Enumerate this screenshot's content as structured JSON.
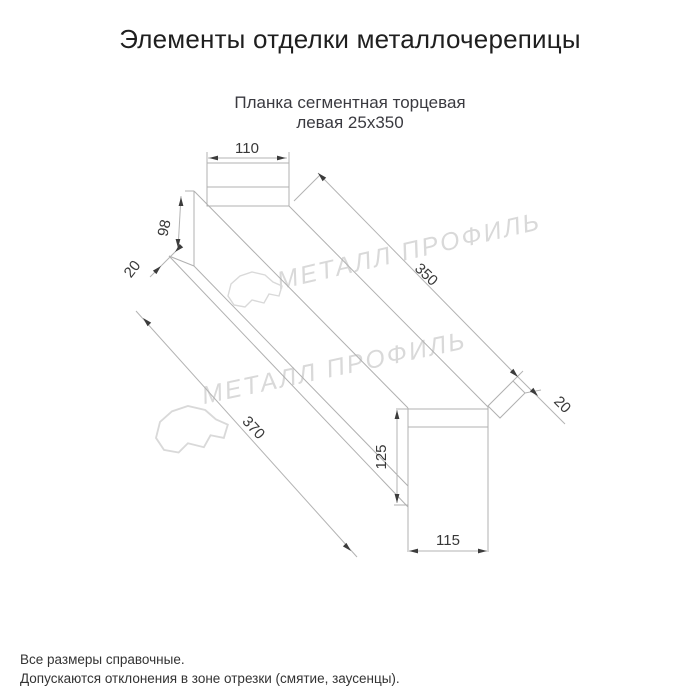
{
  "title": "Элементы отделки металлочерепицы",
  "product": {
    "name_line1": "Планка сегментная торцевая",
    "name_line2": "левая 25х350"
  },
  "drawing": {
    "dims": {
      "top_flange_width": "110",
      "slope_face": "98",
      "hem_near": "20",
      "length_right": "350",
      "hem_far": "20",
      "length_left": "370",
      "end_height": "125",
      "end_width": "115"
    },
    "line_color": "#b0b0b0",
    "dim_text_color": "#383838",
    "watermark": {
      "text": "МЕТАЛЛ ПРОФИЛЬ",
      "color": "#d9d9d9"
    }
  },
  "notes": {
    "line1": "Все размеры справочные.",
    "line2": "Допускаются отклонения в зоне отрезки (смятие, заусенцы)."
  }
}
